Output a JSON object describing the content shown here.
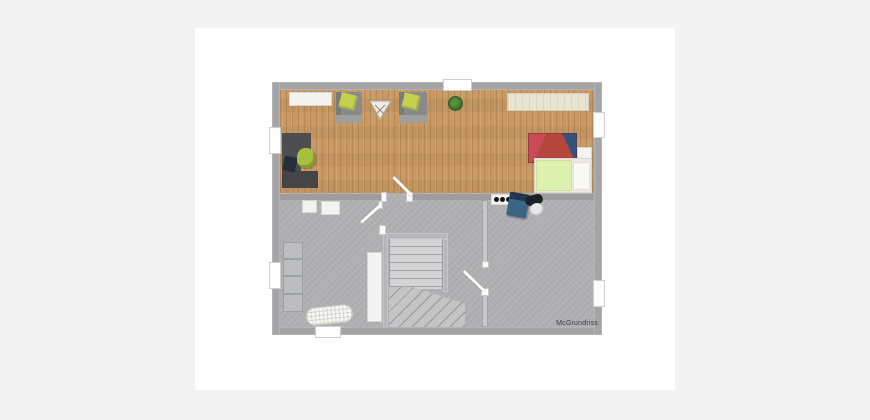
{
  "page": {
    "background_color": "#f3f3f4",
    "card_color": "#ffffff"
  },
  "plan": {
    "type": "floor-plan-render",
    "watermark": "McGrundriss",
    "areas": {
      "upper": "living-and-sleeping-area-wood-floor",
      "lower": "basement-hall-with-staircase-and-utility-rooms"
    },
    "colors": {
      "outer_wall": "#a4a4a6",
      "divider_wall": "#9d9d9f",
      "partition_wall": "#c8c8ca",
      "wood_floor": "#c99a63",
      "basement_floor": "#b0b0b2",
      "armchair_gray": "#8a8a8a",
      "armchair_cushion_green": "#c3d14e",
      "office_chair_green": "#a8bf3e",
      "desk_dark_gray": "#4e4e50",
      "bed_blanket_green": "#def0ad",
      "rug_red": "#b5463c",
      "boiler_blue": "#3c6583",
      "plant_green": "#3e7030",
      "stair_steps": "#d3d3d3"
    },
    "furniture": [
      "sideboard",
      "armchair-left",
      "armchair-right",
      "triangle-side-table",
      "potted-plant",
      "wall-cabinet",
      "corner-desk",
      "laptop",
      "office-chair",
      "area-rug",
      "bed",
      "nightstand",
      "storage-cabinet-1",
      "storage-cabinet-2",
      "wall-shelf",
      "ironing-board",
      "stair-closet",
      "staircase-with-winders",
      "stove-plate",
      "boiler-unit"
    ],
    "openings": {
      "windows": 6,
      "doors": 3
    }
  }
}
